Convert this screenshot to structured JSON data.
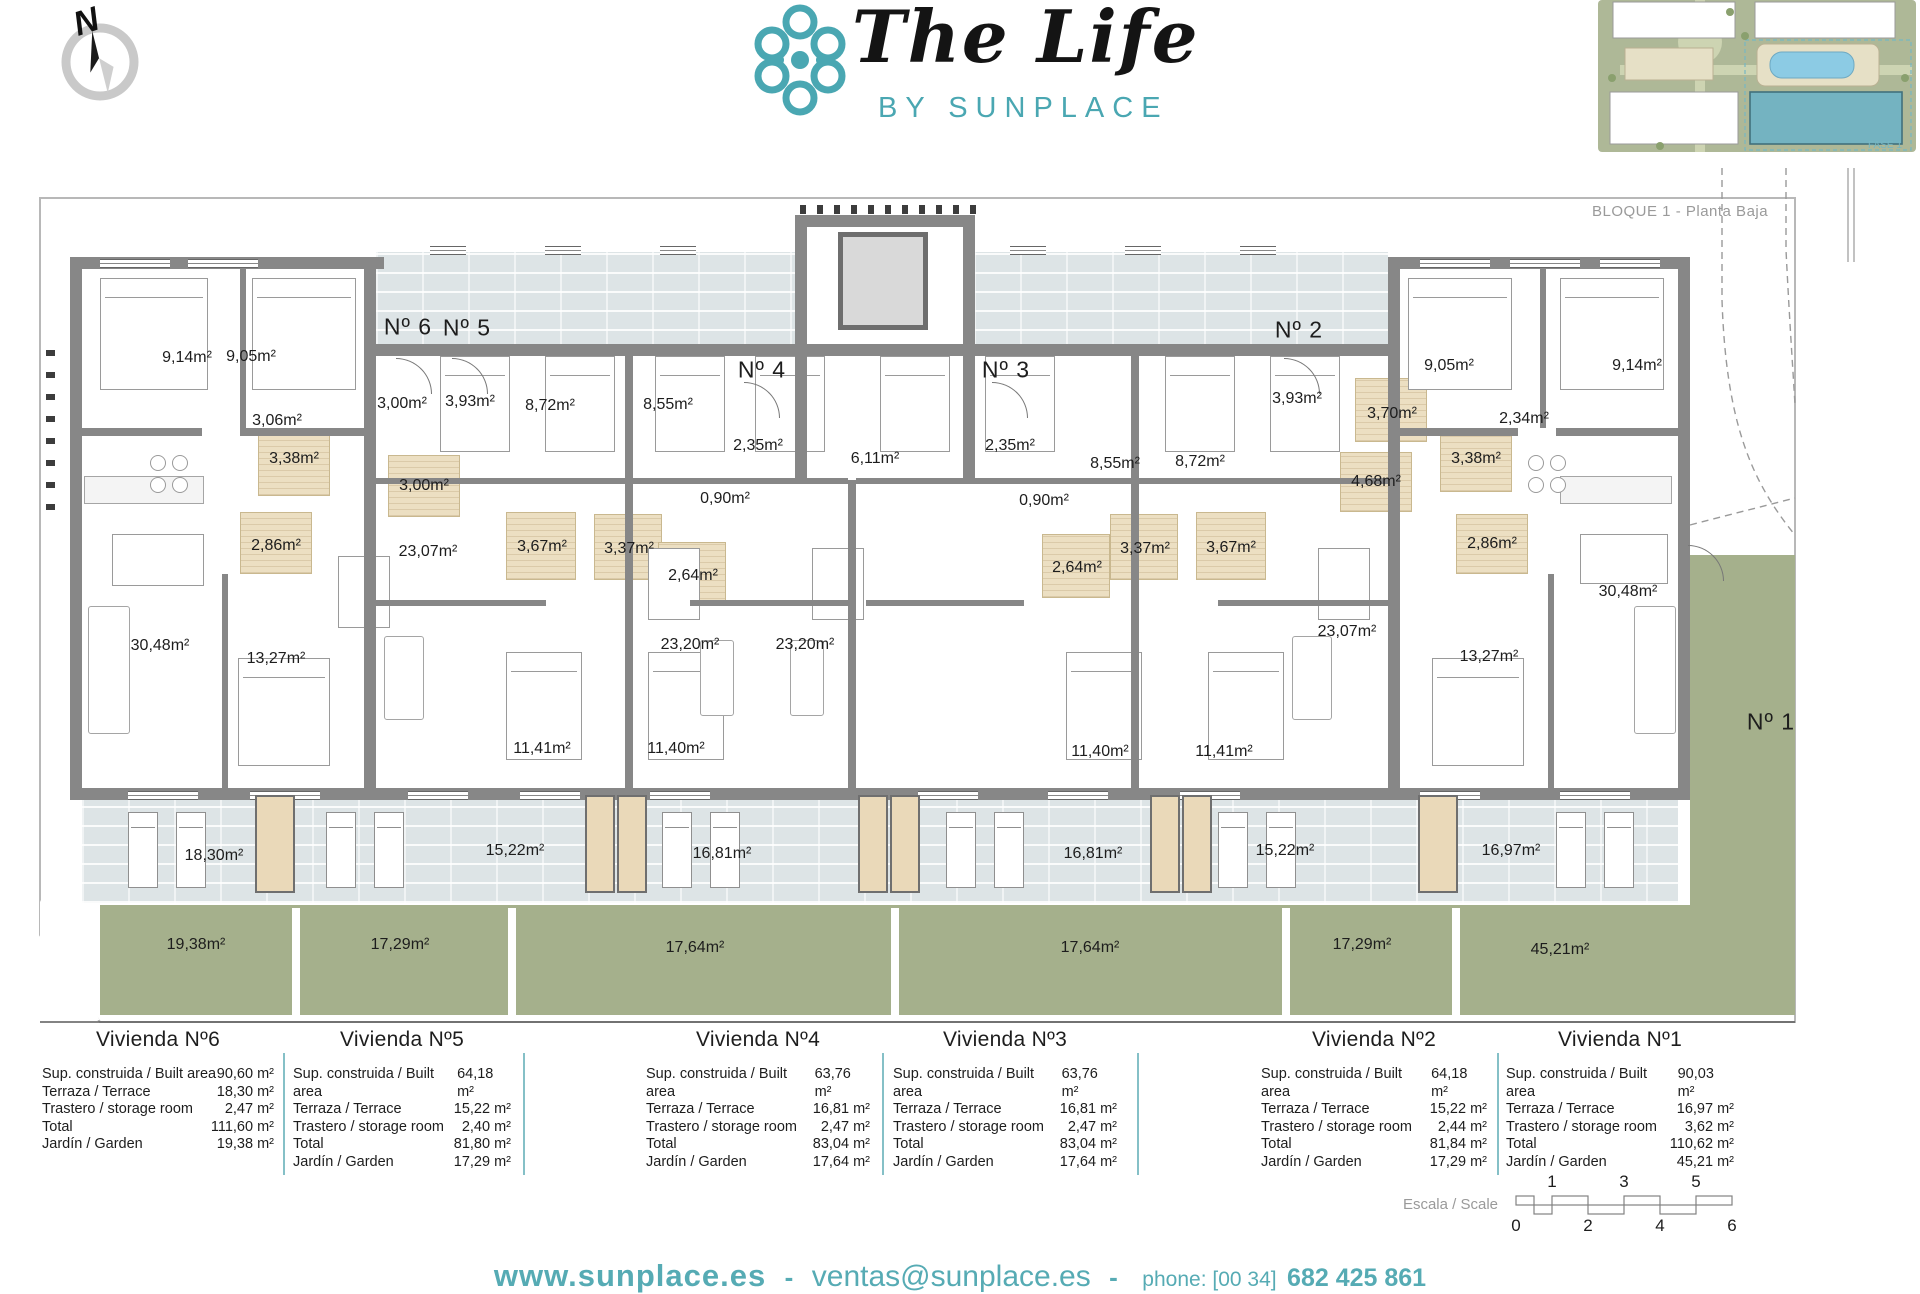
{
  "brand": {
    "title": "The Life",
    "subtitle": "BY SUNPLACE"
  },
  "compass": {
    "label": "N"
  },
  "site_map": {
    "caption": "BLOQUE 1 - Planta Baja",
    "phase_label": "FASE 1"
  },
  "plan": {
    "unit_labels": [
      {
        "t": "Nº 6",
        "x": 408,
        "y": 327
      },
      {
        "t": "Nº 5",
        "x": 467,
        "y": 328
      },
      {
        "t": "Nº 4",
        "x": 762,
        "y": 370
      },
      {
        "t": "Nº 3",
        "x": 1006,
        "y": 370
      },
      {
        "t": "Nº 2",
        "x": 1299,
        "y": 330
      },
      {
        "t": "Nº 1",
        "x": 1771,
        "y": 722
      }
    ],
    "room_labels": [
      {
        "t": "9,14m²",
        "x": 187,
        "y": 358
      },
      {
        "t": "9,05m²",
        "x": 251,
        "y": 357
      },
      {
        "t": "3,06m²",
        "x": 277,
        "y": 421
      },
      {
        "t": "3,00m²",
        "x": 402,
        "y": 404
      },
      {
        "t": "3,93m²",
        "x": 470,
        "y": 402
      },
      {
        "t": "3,38m²",
        "x": 294,
        "y": 459
      },
      {
        "t": "3,00m²",
        "x": 424,
        "y": 486
      },
      {
        "t": "2,86m²",
        "x": 276,
        "y": 546
      },
      {
        "t": "23,07m²",
        "x": 428,
        "y": 552
      },
      {
        "t": "30,48m²",
        "x": 160,
        "y": 646
      },
      {
        "t": "13,27m²",
        "x": 276,
        "y": 659
      },
      {
        "t": "8,72m²",
        "x": 550,
        "y": 406
      },
      {
        "t": "8,55m²",
        "x": 668,
        "y": 405
      },
      {
        "t": "2,35m²",
        "x": 758,
        "y": 446
      },
      {
        "t": "6,11m²",
        "x": 875,
        "y": 459
      },
      {
        "t": "0,90m²",
        "x": 725,
        "y": 499
      },
      {
        "t": "3,67m²",
        "x": 542,
        "y": 547
      },
      {
        "t": "3,37m²",
        "x": 629,
        "y": 549
      },
      {
        "t": "2,64m²",
        "x": 693,
        "y": 576
      },
      {
        "t": "23,20m²",
        "x": 690,
        "y": 645
      },
      {
        "t": "23,20m²",
        "x": 805,
        "y": 645
      },
      {
        "t": "11,41m²",
        "x": 542,
        "y": 749
      },
      {
        "t": "11,40m²",
        "x": 676,
        "y": 749
      },
      {
        "t": "2,35m²",
        "x": 1010,
        "y": 446
      },
      {
        "t": "0,90m²",
        "x": 1044,
        "y": 501
      },
      {
        "t": "8,55m²",
        "x": 1115,
        "y": 464
      },
      {
        "t": "8,72m²",
        "x": 1200,
        "y": 462
      },
      {
        "t": "2,64m²",
        "x": 1077,
        "y": 568
      },
      {
        "t": "3,37m²",
        "x": 1145,
        "y": 549
      },
      {
        "t": "3,67m²",
        "x": 1231,
        "y": 548
      },
      {
        "t": "23,07m²",
        "x": 1347,
        "y": 632
      },
      {
        "t": "11,40m²",
        "x": 1100,
        "y": 752
      },
      {
        "t": "11,41m²",
        "x": 1224,
        "y": 752
      },
      {
        "t": "3,93m²",
        "x": 1297,
        "y": 399
      },
      {
        "t": "3,70m²",
        "x": 1392,
        "y": 414
      },
      {
        "t": "4,68m²",
        "x": 1376,
        "y": 482
      },
      {
        "t": "9,05m²",
        "x": 1449,
        "y": 366
      },
      {
        "t": "9,14m²",
        "x": 1637,
        "y": 366
      },
      {
        "t": "2,34m²",
        "x": 1524,
        "y": 419
      },
      {
        "t": "3,38m²",
        "x": 1476,
        "y": 459
      },
      {
        "t": "2,86m²",
        "x": 1492,
        "y": 544
      },
      {
        "t": "30,48m²",
        "x": 1628,
        "y": 592
      },
      {
        "t": "13,27m²",
        "x": 1489,
        "y": 657
      }
    ],
    "terrace_labels": [
      {
        "t": "18,30m²",
        "x": 214,
        "y": 856
      },
      {
        "t": "15,22m²",
        "x": 515,
        "y": 851
      },
      {
        "t": "16,81m²",
        "x": 722,
        "y": 854
      },
      {
        "t": "16,81m²",
        "x": 1093,
        "y": 854
      },
      {
        "t": "15,22m²",
        "x": 1285,
        "y": 851
      },
      {
        "t": "16,97m²",
        "x": 1511,
        "y": 851
      }
    ],
    "garden_labels": [
      {
        "t": "19,38m²",
        "x": 196,
        "y": 945
      },
      {
        "t": "17,29m²",
        "x": 400,
        "y": 945
      },
      {
        "t": "17,64m²",
        "x": 695,
        "y": 948
      },
      {
        "t": "17,64m²",
        "x": 1090,
        "y": 948
      },
      {
        "t": "17,29m²",
        "x": 1362,
        "y": 945
      },
      {
        "t": "45,21m²",
        "x": 1560,
        "y": 950
      }
    ]
  },
  "tables": {
    "row_headers": [
      "Sup. construida / Built area",
      "Terraza / Terrace",
      "Trastero / storage room",
      "Total",
      "Jardín / Garden"
    ],
    "units": [
      {
        "title": "Vivienda Nº6",
        "values": [
          "90,60 m²",
          "18,30 m²",
          "2,47 m²",
          "111,60 m²",
          "19,38 m²"
        ]
      },
      {
        "title": "Vivienda Nº5",
        "values": [
          "64,18 m²",
          "15,22 m²",
          "2,40 m²",
          "81,80 m²",
          "17,29 m²"
        ]
      },
      {
        "title": "Vivienda Nº4",
        "values": [
          "63,76 m²",
          "16,81 m²",
          "2,47 m²",
          "83,04 m²",
          "17,64 m²"
        ]
      },
      {
        "title": "Vivienda Nº3",
        "values": [
          "63,76 m²",
          "16,81 m²",
          "2,47 m²",
          "83,04 m²",
          "17,64 m²"
        ]
      },
      {
        "title": "Vivienda Nº2",
        "values": [
          "64,18 m²",
          "15,22 m²",
          "2,44 m²",
          "81,84 m²",
          "17,29 m²"
        ]
      },
      {
        "title": "Vivienda Nº1",
        "values": [
          "90,03 m²",
          "16,97 m²",
          "3,62 m²",
          "110,62 m²",
          "45,21 m²"
        ]
      }
    ]
  },
  "scale_bar": {
    "label": "Escala / Scale",
    "top_ticks": [
      "1",
      "3",
      "5"
    ],
    "bottom_ticks": [
      "0",
      "2",
      "4",
      "6"
    ]
  },
  "footer": {
    "website": "www.sunplace.es",
    "separator": "-",
    "email": "ventas@sunplace.es",
    "phone_label": "phone: [00 34]",
    "phone_number": "682 425 861"
  }
}
